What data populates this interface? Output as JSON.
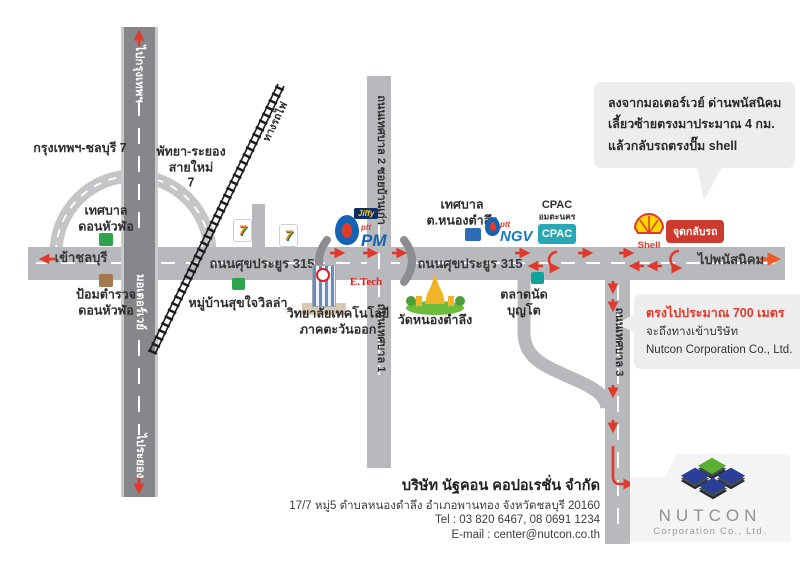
{
  "bubbles": {
    "directions": {
      "line1": "ลงจากมอเตอร์เวย์ ด่านพนัสนิคม",
      "line2": "เลี้ยวซ้ายตรงมาประมาณ 4 กม.",
      "line3": "แล้วกลับรถตรงปั๊ม shell"
    },
    "arrival": {
      "highlight": "ตรงไปประมาณ 700 เมตร",
      "line2": "จะถึงทางเข้าบริษัท",
      "line3": "Nutcon Corporation Co., Ltd."
    }
  },
  "roads": {
    "to_bangkok": "ไปกรุงเทพฯ",
    "motorway": "มอเตอร์เวย์",
    "to_rayong": "ไประยอง",
    "to_chonburi": "เข้าชลบุรี",
    "to_phanat_nikhom": "ไปพนัสนิคม",
    "sukprayoon_left": "ถนนศุขประยูร 315",
    "sukprayoon_right": "ถนนศุขประยูร 315",
    "thetsaban_2": "ถนนเทศบาล 2 ซอยบ้านเก่า",
    "thetsaban_1": "ถนนเทศบาล 1",
    "thetsaban_3": "ถนนเทศบาล 3",
    "railway": "ทางรถไฟ",
    "ramp_bangkok_chonburi": "กรุงเทพฯ-ชลบุรี 7",
    "ramp_pattaya_rayong": "พัทยา-ระยอง\nสายใหม่\n7"
  },
  "places": {
    "don_hua_lo_municipality": "เทศบาล\nดอนหัวฬ่อ",
    "don_hua_lo_police": "ป้อมตำรวจ\nดอนหัวฬ่อ",
    "sukjai_villa": "หมู่บ้านสุขใจวิลล่า",
    "etech_college": "วิทยาลัยเทคโนโลยี\nภาคตะวันออก",
    "etech_label": "E.Tech",
    "wat_nong_tamlueng": "วัดหนองตำลึง",
    "nong_tamlueng_municipality": "เทศบาล\nต.หนองตำลึง",
    "bunto_market": "ตลาดนัด\nบุญโต",
    "uturn_point": "จุดกลับรถ"
  },
  "brands": {
    "seven_eleven": "7",
    "jiffy": "Jiffy",
    "ptt": "ptt",
    "pm": "PM",
    "ngv": "NGV",
    "cpac_title": "CPAC",
    "cpac_subtitle": "อมตะนคร",
    "cpac_box": "CPAC",
    "shell": "Shell"
  },
  "footer": {
    "company_th": "บริษัท นัฐคอน คอปอเรชั่น จำกัด",
    "address": "17/7 หมู่5 ตำบลหนองตำลึง อำเภอพานทอง จังหวัดชลบุรี 20160",
    "tel": "Tel : 03 820 6467, 08 0691 1234",
    "email": "E-mail : center@nutcon.co.th"
  },
  "logo": {
    "name": "NUTCON",
    "subtitle": "Corporation Co., Ltd."
  },
  "colors": {
    "accent_red": "#e0392b",
    "road_gray": "#b7b9bc",
    "motorway_gray": "#85878b",
    "bubble_gray": "#ededee",
    "cpac_teal": "#2aa7b5",
    "ptt_blue": "#1464b3",
    "shell_yellow": "#ffd500",
    "logo_green": "#5cb135",
    "logo_blue": "#2b3f99"
  }
}
